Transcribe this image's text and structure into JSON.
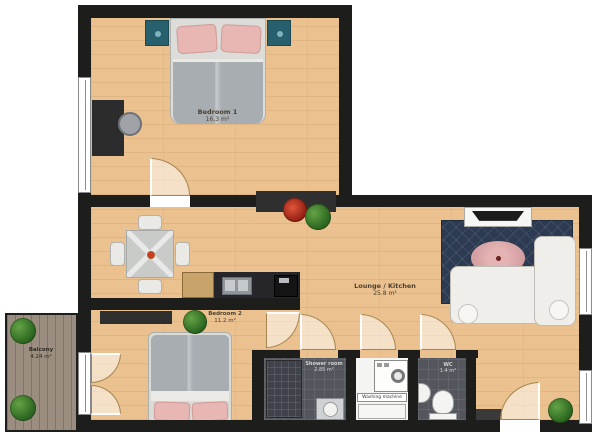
{
  "plan": {
    "rooms": {
      "bedroom1": {
        "label": "Bedroom 1",
        "area": "16.3 m²"
      },
      "bedroom2": {
        "label": "Bedroom 2",
        "area": "11.2 m²"
      },
      "lounge_kitchen": {
        "label": "Lounge / Kitchen",
        "area": "25.8 m²"
      },
      "balcony": {
        "label": "Balcony",
        "area": "4.24 m²"
      },
      "shower_room": {
        "label": "Shower room",
        "area": "2.85 m²"
      },
      "wc": {
        "label": "WC",
        "area": "1.4 m²"
      }
    },
    "appliances": {
      "washing_machine_label": "Washing machine"
    },
    "colors": {
      "wall": "#1d1d1b",
      "wood_floor": "#ebc28f",
      "balcony_deck": "#96897b",
      "tile_dark": "#53565c",
      "rug_navy": "#2c3a52",
      "rug_oval_pink": "#d8a3a6",
      "nightstand_teal": "#275f6d",
      "pillow_pink": "#e8b7b3",
      "plant_green": "#3e7a2e",
      "flower_red": "#b92f1f",
      "sofa_white": "#efeeea"
    }
  }
}
